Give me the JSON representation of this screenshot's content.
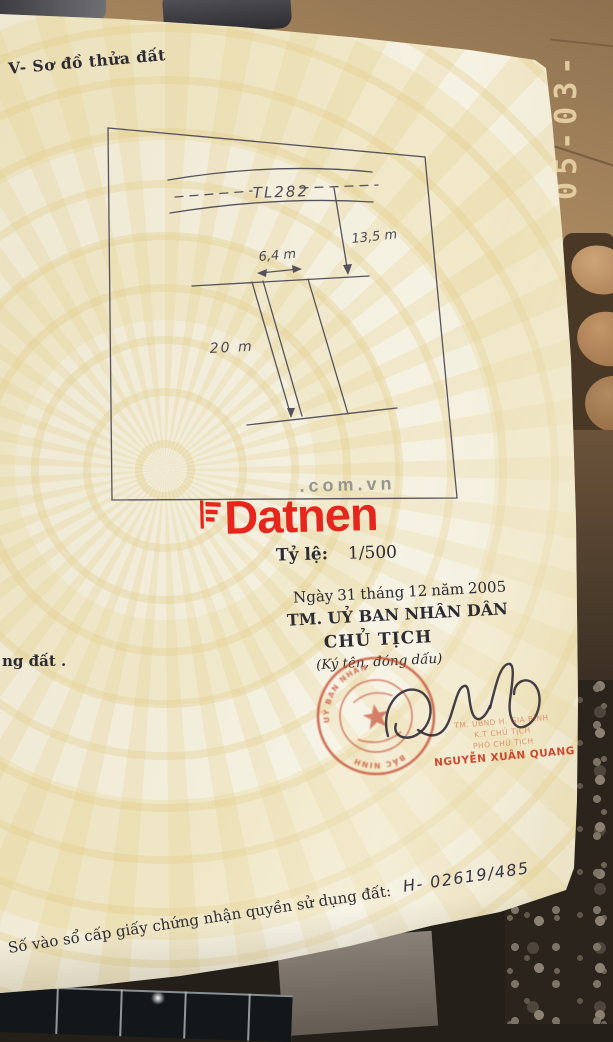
{
  "photo": {
    "edge_timestamp": "05-03-",
    "colors": {
      "floor_brown": "#a8875e",
      "timestamp_gold": "#e6d0a2",
      "page_cream": "#f2edda",
      "pattern_yellow": "#e7d59b"
    }
  },
  "document": {
    "section_title": "V- Sơ đồ thửa đất",
    "diagram": {
      "road_label": "TL282",
      "dim_road_to_plot": "13,5 m",
      "dim_width": "6,4 m",
      "dim_length": "20 m"
    },
    "watermark": {
      "brand": "Datnen",
      "suffix": ".com.vn"
    },
    "scale": {
      "label": "Tỷ lệ:",
      "value": "1/500"
    },
    "date_line": {
      "word_day": "Ngày",
      "day": "31",
      "word_month": "tháng",
      "month": "12",
      "word_year": "năm",
      "year": "2005"
    },
    "authority": {
      "committee": "TM. UỶ BAN NHÂN DÂN",
      "title": "CHỦ TỊCH",
      "sign_note": "(Ký tên, đóng dấu)"
    },
    "seal": {
      "ring_main": "UỶ BAN NHÂN DÂN HUYỆN GIA BÌNH",
      "ring_bottom": "BẮC NINH"
    },
    "signer": {
      "line1": "TM. UBND H. GIA BÌNH",
      "line2": "K.T CHỦ TỊCH",
      "line3": "PHÓ CHỦ TỊCH",
      "name": "NGUYỄN XUÂN QUANG"
    },
    "left_text_fragment": "ng đất .",
    "registry": {
      "label": "Số vào sổ cấp giấy chứng nhận quyền sử dụng đất:",
      "value": "H- 02619/485"
    },
    "colors": {
      "stamp_red": "#c7482e",
      "brand_red": "#e6251c",
      "suffix_gray": "#8e9089",
      "ink": "#2d2b33",
      "pencil_line": "#55525c"
    }
  }
}
